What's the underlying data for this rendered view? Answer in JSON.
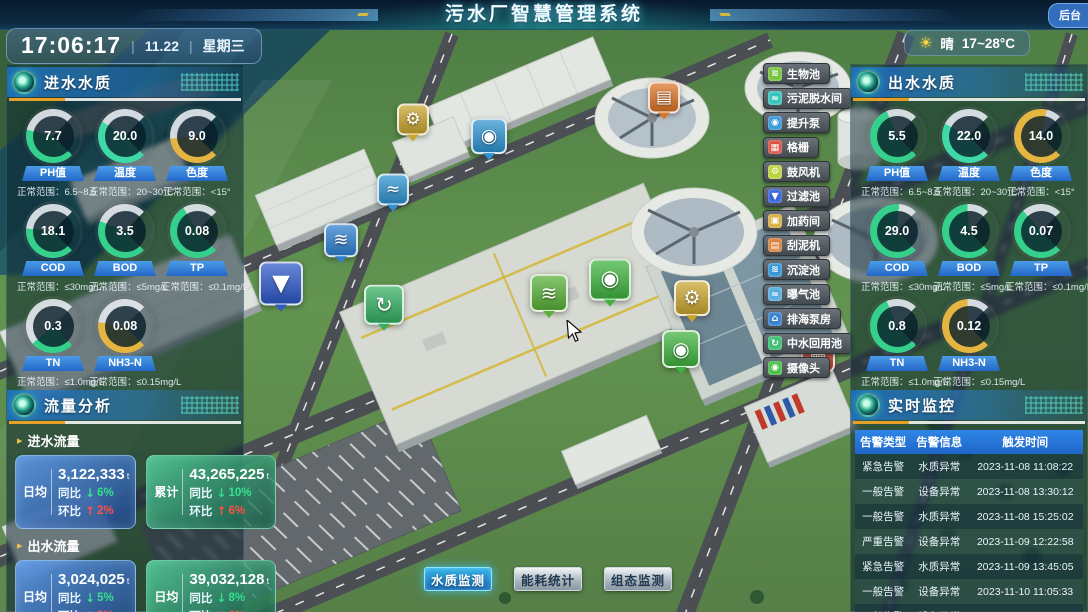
{
  "symbols": {
    "divider": "|",
    "flow_bullet": "▸",
    "arrow_down": "↓",
    "arrow_up": "↑",
    "sun": "☀"
  },
  "colors": {
    "accent_blue": "#2f7fd6",
    "ok_green": "#35d08c",
    "warn_yellow": "#e5b542",
    "alarm_red": "#ff5044",
    "trend_down_green": "#35e08a",
    "trend_up_red": "#ff5044"
  },
  "header": {
    "title": "污水厂智慧管理系统",
    "time": "17:06:17",
    "date": "11.22",
    "weekday": "星期三",
    "weather_condition": "晴",
    "weather_temp": "17~28°C",
    "backend_label": "后台"
  },
  "inlet_quality": {
    "title": "进水水质",
    "gauges": [
      {
        "value": "7.7",
        "label": "PH值",
        "range": "正常范围：6.5~8.5",
        "color": "#35d08c",
        "pct": 55
      },
      {
        "value": "20.0",
        "label": "温度",
        "range": "正常范围：20~30°C",
        "color": "#3fd9a8",
        "pct": 62
      },
      {
        "value": "9.0",
        "label": "色度",
        "range": "正常范围：<15°",
        "color": "#e5b542",
        "pct": 48
      },
      {
        "value": "18.1",
        "label": "COD",
        "range": "正常范围：≤30mg/L",
        "color": "#35d08c",
        "pct": 52
      },
      {
        "value": "3.5",
        "label": "BOD",
        "range": "正常范围：≤5mg/L",
        "color": "#35d08c",
        "pct": 58
      },
      {
        "value": "0.08",
        "label": "TP",
        "range": "正常范围：≤0.1mg/L",
        "color": "#35d08c",
        "pct": 72
      },
      {
        "value": "0.3",
        "label": "TN",
        "range": "正常范围：≤1.0mg/L",
        "color": "#35d08c",
        "pct": 35
      },
      {
        "value": "0.08",
        "label": "NH3-N",
        "range": "正常范围：≤0.15mg/L",
        "color": "#e5b542",
        "pct": 53
      }
    ]
  },
  "outlet_quality": {
    "title": "出水水质",
    "gauges": [
      {
        "value": "5.5",
        "label": "PH值",
        "range": "正常范围：6.5~8.5",
        "color": "#35d08c",
        "pct": 75
      },
      {
        "value": "22.0",
        "label": "温度",
        "range": "正常范围：20~30°C",
        "color": "#3fd9a8",
        "pct": 60
      },
      {
        "value": "14.0",
        "label": "色度",
        "range": "正常范围：<15°",
        "color": "#e5b542",
        "pct": 88
      },
      {
        "value": "29.0",
        "label": "COD",
        "range": "正常范围：≤30mg/L",
        "color": "#35d08c",
        "pct": 85
      },
      {
        "value": "4.5",
        "label": "BOD",
        "range": "正常范围：≤5mg/L",
        "color": "#35d08c",
        "pct": 82
      },
      {
        "value": "0.07",
        "label": "TP",
        "range": "正常范围：≤0.1mg/L",
        "color": "#35d08c",
        "pct": 68
      },
      {
        "value": "0.8",
        "label": "TN",
        "range": "正常范围：≤1.0mg/L",
        "color": "#35d08c",
        "pct": 75
      },
      {
        "value": "0.12",
        "label": "NH3-N",
        "range": "正常范围：≤0.15mg/L",
        "color": "#e5b542",
        "pct": 82
      }
    ]
  },
  "flow_analysis": {
    "title": "流量分析",
    "groups": [
      {
        "label": "进水流量",
        "cards": [
          {
            "tag": "日均",
            "value": "3,122,333",
            "unit": "t",
            "yoy_label": "同比",
            "yoy": "6%",
            "yoy_dir": "down",
            "mom_label": "环比",
            "mom": "2%",
            "mom_dir": "up",
            "style": "blue"
          },
          {
            "tag": "累计",
            "value": "43,265,225",
            "unit": "t",
            "yoy_label": "同比",
            "yoy": "10%",
            "yoy_dir": "down",
            "mom_label": "环比",
            "mom": "6%",
            "mom_dir": "up",
            "style": "green"
          }
        ]
      },
      {
        "label": "出水流量",
        "cards": [
          {
            "tag": "日均",
            "value": "3,024,025",
            "unit": "t",
            "yoy_label": "同比",
            "yoy": "5%",
            "yoy_dir": "down",
            "mom_label": "环比",
            "mom": "3%",
            "mom_dir": "up",
            "style": "blue"
          },
          {
            "tag": "日均",
            "value": "39,032,128",
            "unit": "t",
            "yoy_label": "同比",
            "yoy": "8%",
            "yoy_dir": "down",
            "mom_label": "环比",
            "mom": "6%",
            "mom_dir": "up",
            "style": "green"
          }
        ]
      }
    ]
  },
  "monitoring": {
    "title": "实时监控",
    "columns": [
      "告警类型",
      "告警信息",
      "触发时间"
    ],
    "rows": [
      [
        "紧急告警",
        "水质异常",
        "2023-11-08 11:08:22"
      ],
      [
        "一般告警",
        "设备异常",
        "2023-11-08 13:30:12"
      ],
      [
        "一般告警",
        "水质异常",
        "2023-11-08 15:25:02"
      ],
      [
        "严重告警",
        "设备异常",
        "2023-11-09 12:22:58"
      ],
      [
        "紧急告警",
        "水质异常",
        "2023-11-09 13:45:05"
      ],
      [
        "一般告警",
        "设备异常",
        "2023-11-10 11:05:33"
      ],
      [
        "一般告警",
        "设备异常",
        "2023-11-10 15:02:44"
      ]
    ]
  },
  "facility_menu": [
    {
      "label": "生物池",
      "color": "#77c43c",
      "glyph": "≋"
    },
    {
      "label": "污泥脱水间",
      "color": "#38c4bc",
      "glyph": "≈"
    },
    {
      "label": "提升泵",
      "color": "#3796d8",
      "glyph": "◉"
    },
    {
      "label": "格栅",
      "color": "#d8503f",
      "glyph": "▦"
    },
    {
      "label": "鼓风机",
      "color": "#bcd23c",
      "glyph": "⚙"
    },
    {
      "label": "过滤池",
      "color": "#3763d8",
      "glyph": "▼"
    },
    {
      "label": "加药间",
      "color": "#d8ab3c",
      "glyph": "▣"
    },
    {
      "label": "刮泥机",
      "color": "#d8813c",
      "glyph": "▤"
    },
    {
      "label": "沉淀池",
      "color": "#3796d8",
      "glyph": "≋"
    },
    {
      "label": "曝气池",
      "color": "#57aede",
      "glyph": "≈"
    },
    {
      "label": "排海泵房",
      "color": "#3781d0",
      "glyph": "⌂"
    },
    {
      "label": "中水回用池",
      "color": "#3fbf72",
      "glyph": "↻"
    },
    {
      "label": "摄像头",
      "color": "#46bf46",
      "glyph": "◉"
    }
  ],
  "bottom_tabs": [
    {
      "label": "水质监测",
      "active": true
    },
    {
      "label": "能耗统计",
      "active": false
    },
    {
      "label": "组态监测",
      "active": false
    }
  ],
  "scene_markers": [
    {
      "name": "blower-fan",
      "glyph": "⚙",
      "color": "#c9a52e",
      "x": 413,
      "y": 122,
      "s": 32
    },
    {
      "name": "lift-pump",
      "glyph": "◉",
      "color": "#2e93d0",
      "x": 489,
      "y": 139,
      "s": 36
    },
    {
      "name": "sludge-dewatering",
      "glyph": "▤",
      "color": "#dd7427",
      "x": 664,
      "y": 100,
      "s": 32
    },
    {
      "name": "pool",
      "glyph": "≈",
      "color": "#2e93d0",
      "x": 393,
      "y": 192,
      "s": 32
    },
    {
      "name": "sedimentation-pool",
      "glyph": "≋",
      "color": "#2e7fd0",
      "x": 341,
      "y": 243,
      "s": 34
    },
    {
      "name": "filter-pool",
      "glyph": "▼",
      "color": "#2e58c8",
      "x": 281,
      "y": 287,
      "s": 44
    },
    {
      "name": "reuse-pool",
      "glyph": "↻",
      "color": "#34b063",
      "x": 384,
      "y": 308,
      "s": 40
    },
    {
      "name": "aeration-pool",
      "glyph": "≋",
      "color": "#58b038",
      "x": 549,
      "y": 296,
      "s": 38
    },
    {
      "name": "camera",
      "glyph": "◉",
      "color": "#3fb33f",
      "x": 610,
      "y": 283,
      "s": 42
    },
    {
      "name": "blower-fan",
      "glyph": "⚙",
      "color": "#c9a52e",
      "x": 692,
      "y": 301,
      "s": 36
    },
    {
      "name": "camera",
      "glyph": "◉",
      "color": "#3fb33f",
      "x": 681,
      "y": 352,
      "s": 38
    },
    {
      "name": "grille",
      "glyph": "▦",
      "color": "#cf4434",
      "x": 818,
      "y": 358,
      "s": 34
    }
  ]
}
